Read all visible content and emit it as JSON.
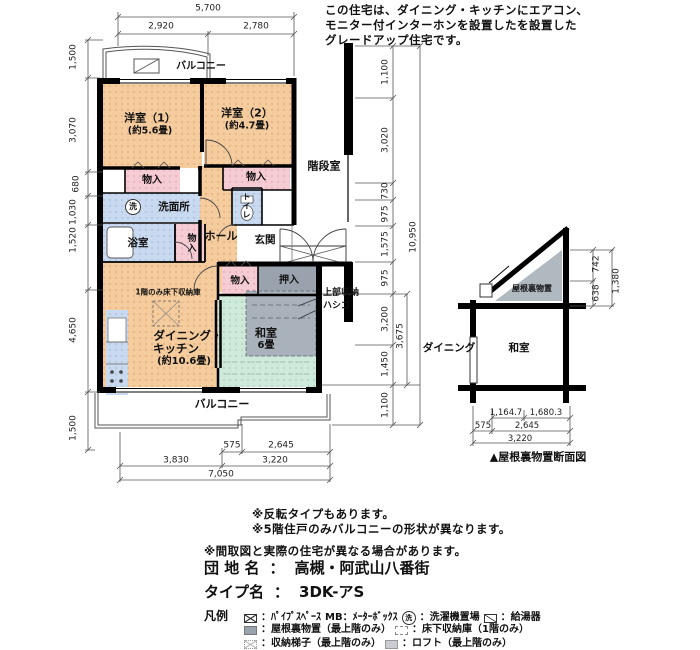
{
  "note": {
    "l1": "この住宅は、ダイニング・キッチンにエアコン、",
    "l2": "モニター付インターホンを設置したを設置した",
    "l3": "グレードアップ住宅です。"
  },
  "rooms": {
    "y1": "洋室（1）",
    "y1s": "(約5.6畳)",
    "y2": "洋室（2）",
    "y2s": "(約4.7畳)",
    "kaidan": "階段室",
    "mono": "物入",
    "senmen": "洗面所",
    "sen": "洗",
    "toilet": "トイレ",
    "bath": "浴室",
    "hall": "ホール",
    "genkan": "玄関",
    "oshiire": "押入",
    "yukashita": "1階のみ床下収納庫",
    "dk1": "ダイニング・",
    "dk2": "キッチン",
    "dk3": "(約10.6畳)",
    "washitsu": "和室",
    "washitsu_s": "6畳",
    "jobu1": "上部収納",
    "jobu2": "ハシゴ",
    "balcony": "バルコニー"
  },
  "dims": {
    "t5700": "5,700",
    "t2920": "2,920",
    "t2780": "2,780",
    "l1500a": "1,500",
    "l3070": "3,070",
    "l680": "680",
    "l1030": "1,030",
    "l1520": "1,520",
    "l4650": "4,650",
    "l1500b": "1,500",
    "r1100a": "1,100",
    "r3020": "3,020",
    "r730": "730",
    "r975a": "975",
    "r1575": "1,575",
    "r10950": "10,950",
    "r975b": "975",
    "r3200": "3,200",
    "r3675": "3,675",
    "r1450": "1,450",
    "r1100b": "1,100",
    "b575": "575",
    "b2645": "2,645",
    "b3830": "3,830",
    "b3220": "3,220",
    "b7050": "7,050"
  },
  "section": {
    "dining": "ダイニング",
    "washitsu": "和室",
    "yaneura": "屋根裏物置",
    "s742": "742",
    "s638": "638",
    "s1380": "1,380",
    "sb1": "1,164.7",
    "sb2": "1,680.3",
    "sb575": "575",
    "sb2645": "2,645",
    "sb3220": "3,220",
    "caption": "▲屋根裏物置断面図"
  },
  "notes": {
    "n1": "※反転タイプもあります。",
    "n2": "※5階住戸のみバルコニーの形状が異なります。",
    "n3": "※間取図と実際の住宅が異なる場合があります。"
  },
  "info": {
    "danchi_label": "団 地 名",
    "sep": "：",
    "danchi_value": "高槻・阿武山八番街",
    "type_label": "タイプ名",
    "type_value": "3DK-アS"
  },
  "legend": {
    "title": "凡例",
    "washer_char": "洗",
    "pipe": "：ﾊﾟｲﾌﾟｽﾍﾟｰｽ",
    "mb": "MB：ﾒｰﾀｰﾎﾞｯｸｽ",
    "washer": "：洗濯機置場",
    "heater": "：給湯器",
    "attic": "：屋根裏物置（最上階のみ）",
    "underfloor": "：床下収納庫（1階のみ）",
    "ladder": "：収納梯子（最上階のみ）",
    "loft": "：ロフト（最上階のみ）"
  },
  "colors": {
    "room_orange": "#f5cc9e",
    "closet_pink": "#f6ccd4",
    "wet_blue": "#c9d9ef",
    "tatami_green": "#cfe9da",
    "storage_gray": "#9aa3ad",
    "overlay_gray": "#a9b1bb",
    "attic_gray": "#b0b8c0",
    "wall": "#000000"
  }
}
